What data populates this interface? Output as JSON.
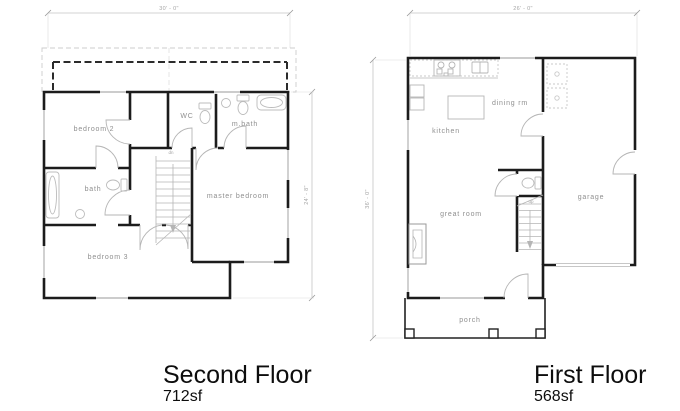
{
  "page": {
    "background": "#ffffff"
  },
  "colors": {
    "wall": "#1c1c1c",
    "fixture": "#b5b5b5",
    "dimension": "#9a9a9a",
    "room_label": "#8f8f8f",
    "deck_dash_bold": "#2b2b2b",
    "deck_dash_light": "#cccccc"
  },
  "plans": {
    "second_floor": {
      "title": "Second Floor",
      "area": "712sf",
      "rooms": {
        "bedroom2": "bedroom 2",
        "wc": "WC",
        "mbath": "m.bath",
        "bath": "bath",
        "master_bedroom": "master bedroom",
        "bedroom3": "bedroom 3"
      },
      "stairs_label": "dn",
      "dimensions": {
        "width": "30' - 0\"",
        "height": "24' - 8\""
      }
    },
    "first_floor": {
      "title": "First Floor",
      "area": "568sf",
      "rooms": {
        "kitchen": "kitchen",
        "dining": "dining rm",
        "great_room": "great room",
        "garage": "garage",
        "porch": "porch"
      },
      "stairs_label": "up",
      "dimensions": {
        "width": "26' - 0\"",
        "height": "36' - 0\""
      }
    }
  }
}
